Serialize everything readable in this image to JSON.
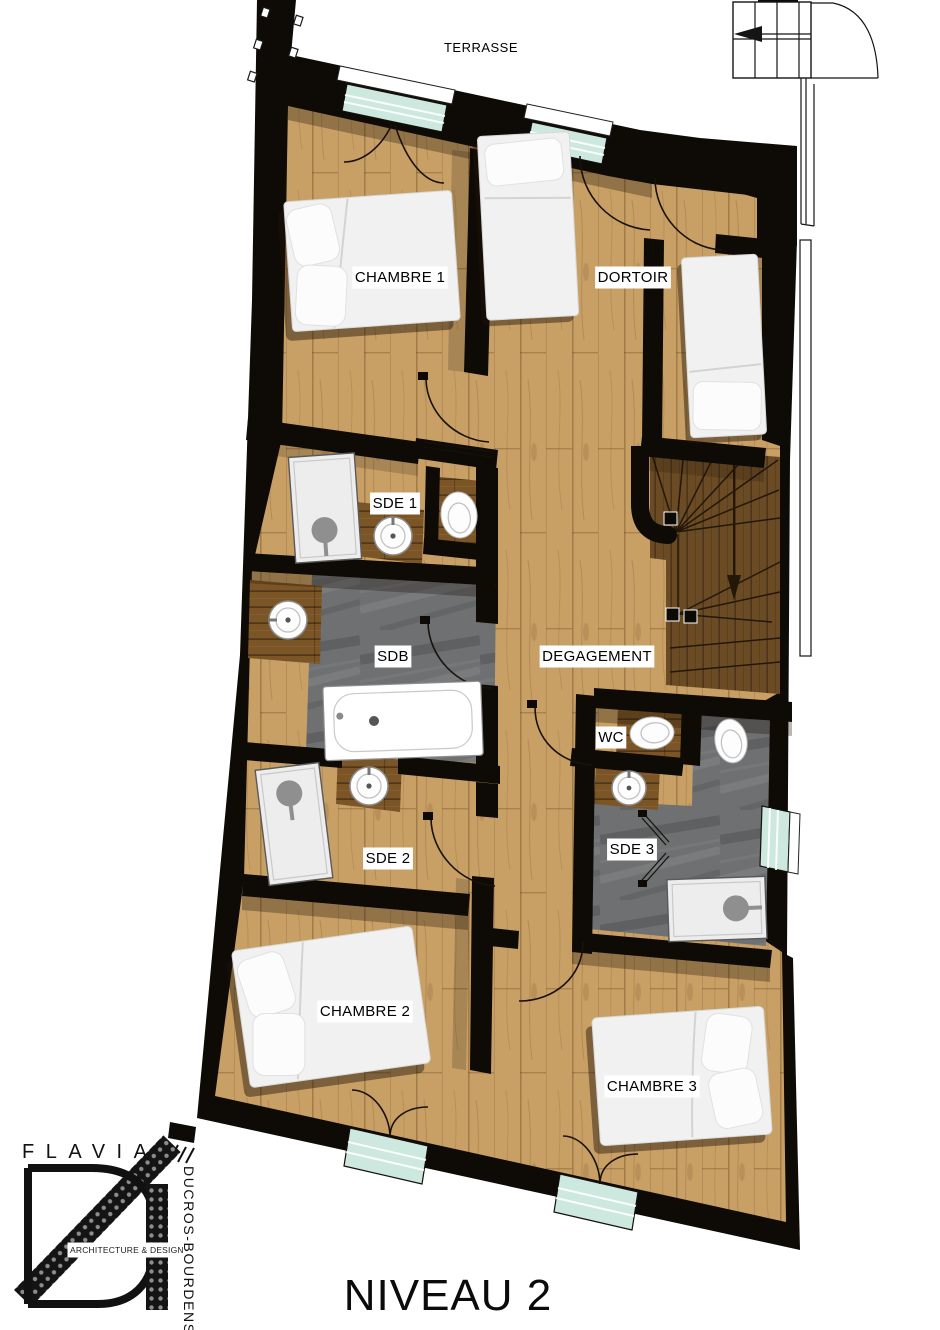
{
  "title": "NIVEAU 2",
  "terrace_label": "TERRASSE",
  "rooms": [
    {
      "id": "chambre-1",
      "label": "CHAMBRE 1"
    },
    {
      "id": "dortoir",
      "label": "DORTOIR"
    },
    {
      "id": "sde-1",
      "label": "SDE 1"
    },
    {
      "id": "sdb",
      "label": "SDB"
    },
    {
      "id": "degagement",
      "label": "DEGAGEMENT"
    },
    {
      "id": "wc",
      "label": "WC"
    },
    {
      "id": "sde-2",
      "label": "SDE 2"
    },
    {
      "id": "sde-3",
      "label": "SDE 3"
    },
    {
      "id": "chambre-2",
      "label": "CHAMBRE 2"
    },
    {
      "id": "chambre-3",
      "label": "CHAMBRE 3"
    }
  ],
  "features": {
    "stairs_arrow_direction": "down",
    "exterior_stairs_arrow_direction": "left"
  },
  "logo": {
    "name": "FLAVIA",
    "surname": "DUCROS-BOURDENS",
    "tagline": "ARCHITECTURE & DESIGN"
  },
  "colors": {
    "wall": "#0e0a06",
    "wood": "#c8a066",
    "wood_dark": "#7b5526",
    "stair_wood": "#6a4b24",
    "slate": "#6e7072",
    "glass": "#cde8df",
    "shower_head": "#8f8f8f",
    "line": "#1a120a"
  }
}
